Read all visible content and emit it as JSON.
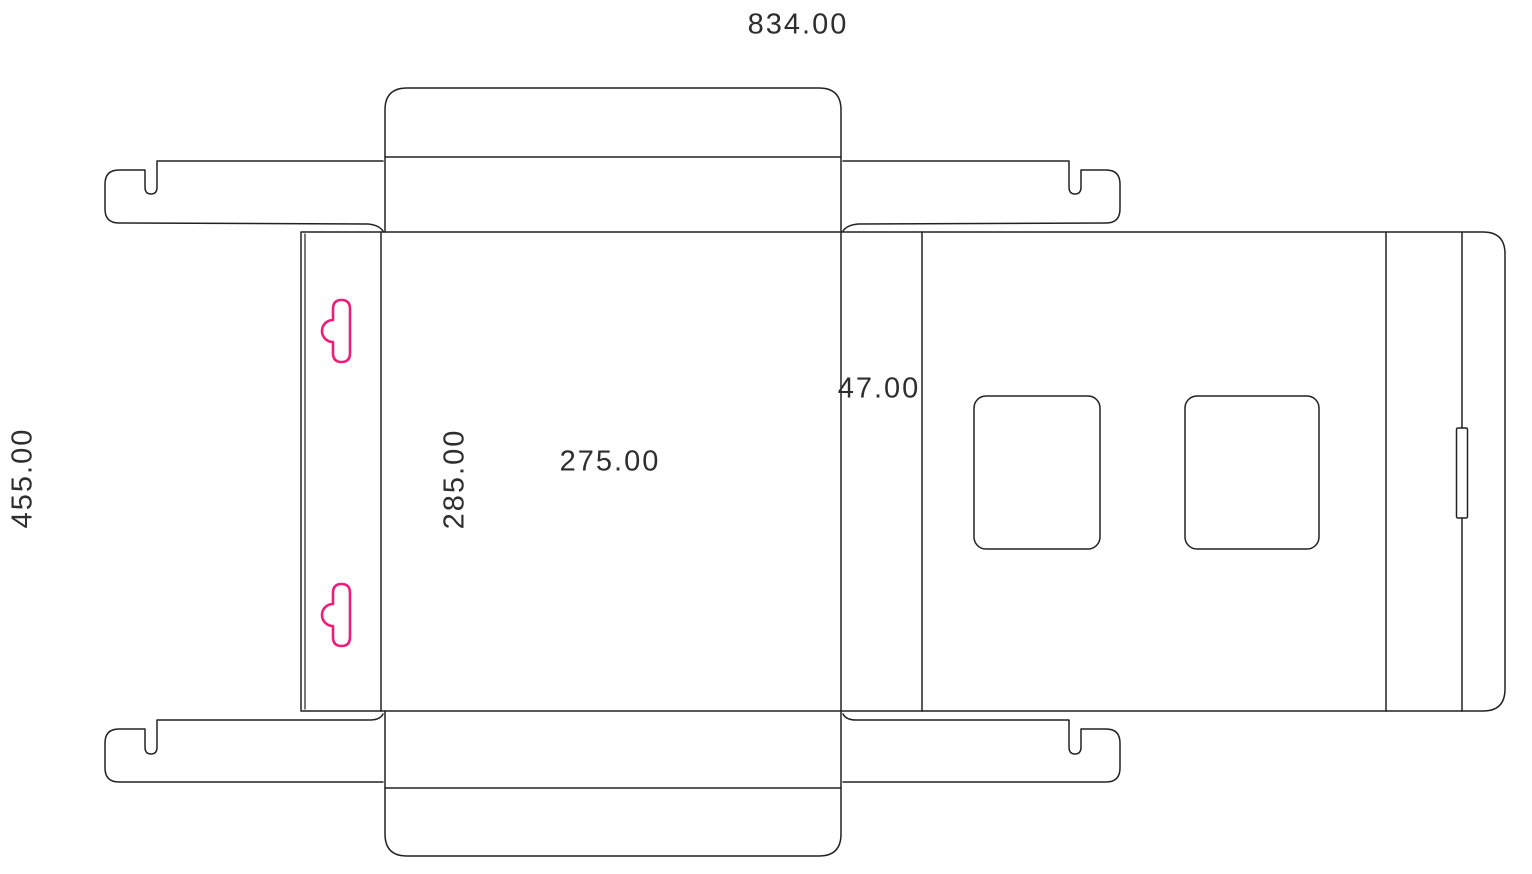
{
  "colors": {
    "cut_line": "#222222",
    "accent_pink": "#ee1d7a",
    "text": "#2e2e2e",
    "background": "#ffffff"
  },
  "dimensions": {
    "overall_width": "834.00",
    "overall_height": "455.00",
    "left_panel_height": "285.00",
    "main_panel_width": "275.00",
    "side_strip_width": "47.00"
  }
}
